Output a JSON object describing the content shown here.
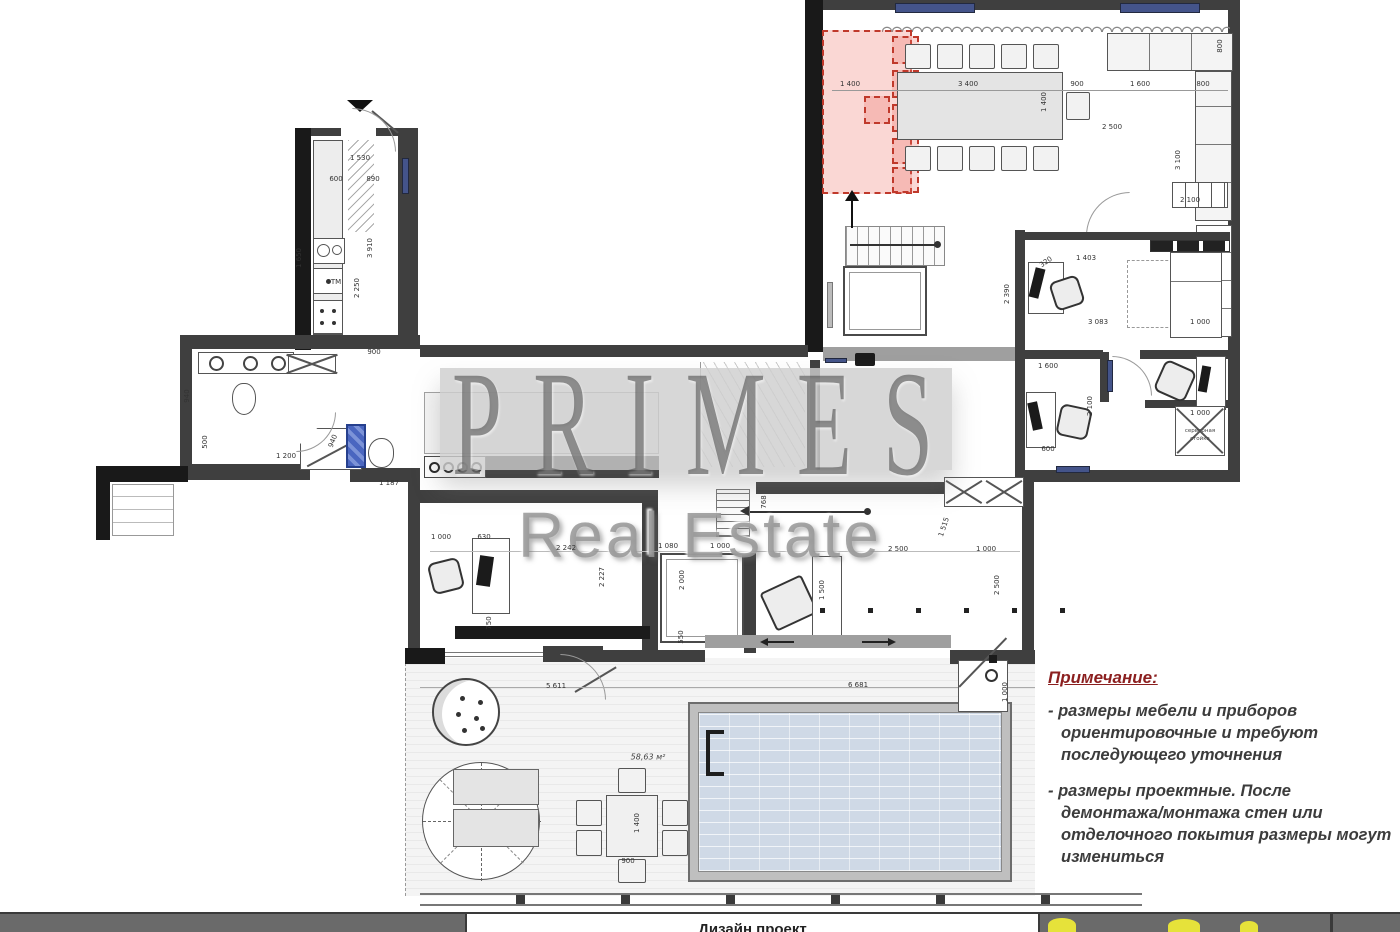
{
  "watermark": {
    "primes": "PRIMES",
    "real_estate": "Real Estate"
  },
  "note": {
    "title": "Примечание:",
    "lines": [
      "-  размеры мебели  и приборов",
      "ориентировочные  и требуют",
      "последующего  уточнения",
      "- размеры проектные. После",
      "демонтажа/монтажа стен  или",
      "отделочного покытия  размеры могут",
      "измениться"
    ]
  },
  "labels": {
    "server_rack_line1": "серверная",
    "server_rack_line2": "стойка",
    "terrace_area": "58,63 м²"
  },
  "titlebar": {
    "project_text": "Дизайн проект"
  },
  "colors": {
    "red_zone": "#e74c3c",
    "window_blue": "#44548a",
    "pool_blue": "#cfd9e6",
    "note_red": "#8b1f1f",
    "logo_yellow": "#e6e23a",
    "wall_dark": "#3f3f3f"
  },
  "dims": [
    {
      "t": "1 400",
      "x": 850,
      "y": 84
    },
    {
      "t": "3 400",
      "x": 968,
      "y": 84
    },
    {
      "t": "900",
      "x": 1077,
      "y": 84
    },
    {
      "t": "1 600",
      "x": 1140,
      "y": 84
    },
    {
      "t": "800",
      "x": 1203,
      "y": 84
    },
    {
      "t": "1 400",
      "x": 1044,
      "y": 102,
      "r": -90
    },
    {
      "t": "2 500",
      "x": 1112,
      "y": 127
    },
    {
      "t": "3 100",
      "x": 1178,
      "y": 160,
      "r": -90
    },
    {
      "t": "800",
      "x": 1220,
      "y": 46,
      "r": -90
    },
    {
      "t": "320",
      "x": 1046,
      "y": 262,
      "r": -35
    },
    {
      "t": "1 403",
      "x": 1086,
      "y": 258
    },
    {
      "t": "3 083",
      "x": 1098,
      "y": 322
    },
    {
      "t": "1 000",
      "x": 1200,
      "y": 322
    },
    {
      "t": "2 100",
      "x": 1190,
      "y": 200
    },
    {
      "t": "2 390",
      "x": 1007,
      "y": 294,
      "r": -90
    },
    {
      "t": "1 600",
      "x": 1048,
      "y": 366
    },
    {
      "t": "2 100",
      "x": 1090,
      "y": 406,
      "r": -90
    },
    {
      "t": "600",
      "x": 1048,
      "y": 449
    },
    {
      "t": "1 000",
      "x": 1200,
      "y": 413
    },
    {
      "t": "1 530",
      "x": 360,
      "y": 158
    },
    {
      "t": "600",
      "x": 336,
      "y": 179
    },
    {
      "t": "890",
      "x": 373,
      "y": 179
    },
    {
      "t": "1 650",
      "x": 299,
      "y": 258,
      "r": -90
    },
    {
      "t": "2 250",
      "x": 357,
      "y": 288,
      "r": -90
    },
    {
      "t": "3 910",
      "x": 370,
      "y": 248,
      "r": -90
    },
    {
      "t": "900",
      "x": 374,
      "y": 352
    },
    {
      "t": "ТМ",
      "x": 336,
      "y": 282
    },
    {
      "t": "940",
      "x": 187,
      "y": 396,
      "r": -90
    },
    {
      "t": "500",
      "x": 205,
      "y": 442,
      "r": -90
    },
    {
      "t": "1 200",
      "x": 286,
      "y": 456
    },
    {
      "t": "940",
      "x": 333,
      "y": 441,
      "r": -68
    },
    {
      "t": "1 187",
      "x": 389,
      "y": 483
    },
    {
      "t": "1 000",
      "x": 441,
      "y": 537
    },
    {
      "t": "630",
      "x": 484,
      "y": 537
    },
    {
      "t": "2 242",
      "x": 566,
      "y": 548
    },
    {
      "t": "2 227",
      "x": 602,
      "y": 577,
      "r": -90
    },
    {
      "t": "750",
      "x": 489,
      "y": 623,
      "r": -90
    },
    {
      "t": "1 080",
      "x": 668,
      "y": 546
    },
    {
      "t": "1 000",
      "x": 720,
      "y": 546
    },
    {
      "t": "2 000",
      "x": 682,
      "y": 580,
      "r": -90
    },
    {
      "t": "550",
      "x": 681,
      "y": 637,
      "r": -90
    },
    {
      "t": "768",
      "x": 764,
      "y": 502,
      "r": -90
    },
    {
      "t": "2 500",
      "x": 898,
      "y": 549
    },
    {
      "t": "1 000",
      "x": 986,
      "y": 549
    },
    {
      "t": "1 515",
      "x": 944,
      "y": 527,
      "r": -72
    },
    {
      "t": "1 500",
      "x": 822,
      "y": 590,
      "r": -90
    },
    {
      "t": "2 500",
      "x": 997,
      "y": 585,
      "r": -90
    },
    {
      "t": "5 611",
      "x": 556,
      "y": 686
    },
    {
      "t": "6 681",
      "x": 858,
      "y": 685
    },
    {
      "t": "1 400",
      "x": 637,
      "y": 823,
      "r": -90
    },
    {
      "t": "900",
      "x": 628,
      "y": 861
    },
    {
      "t": "1 000",
      "x": 1005,
      "y": 692,
      "r": -90
    }
  ]
}
